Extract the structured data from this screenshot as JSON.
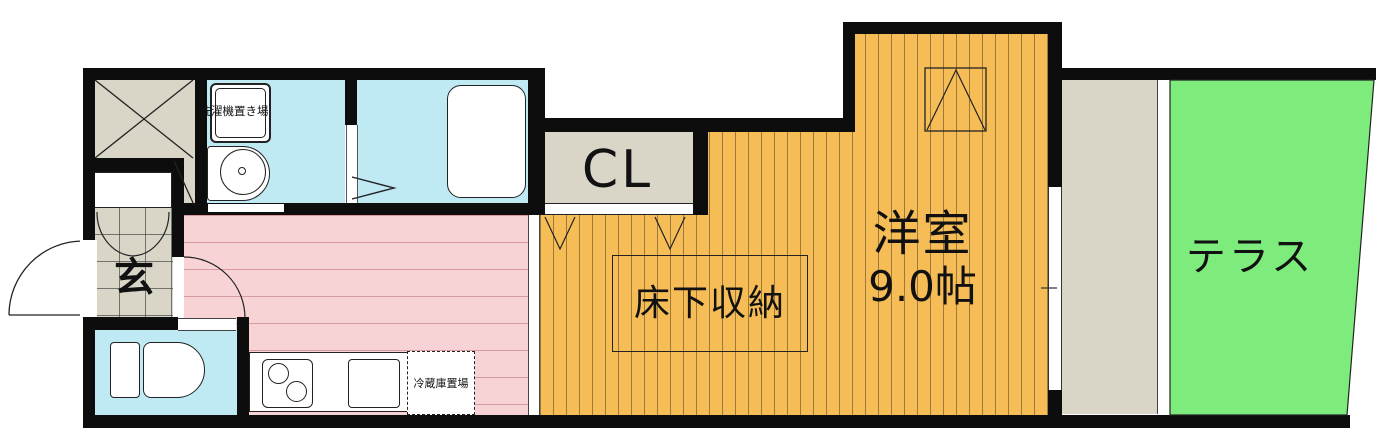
{
  "plan": {
    "type": "apartment-floor-plan",
    "labels": {
      "entrance": "玄",
      "washer": "洗濯機置き場",
      "closet": "CL",
      "underfloor_storage": "床下収納",
      "main_room": "洋室",
      "main_room_size": "9.0帖",
      "fridge_space": "冷蔵庫置場",
      "terrace": "テラス"
    },
    "colors": {
      "wall": "#0d0d0d",
      "wet_area_floor": "#bfeaf4",
      "kitchen_floor": "#f8d3d6",
      "main_room_floor": "#f6bd57",
      "terrace": "#7dec7d",
      "closet_floor": "#d9d6c8",
      "line": "#222222"
    }
  }
}
